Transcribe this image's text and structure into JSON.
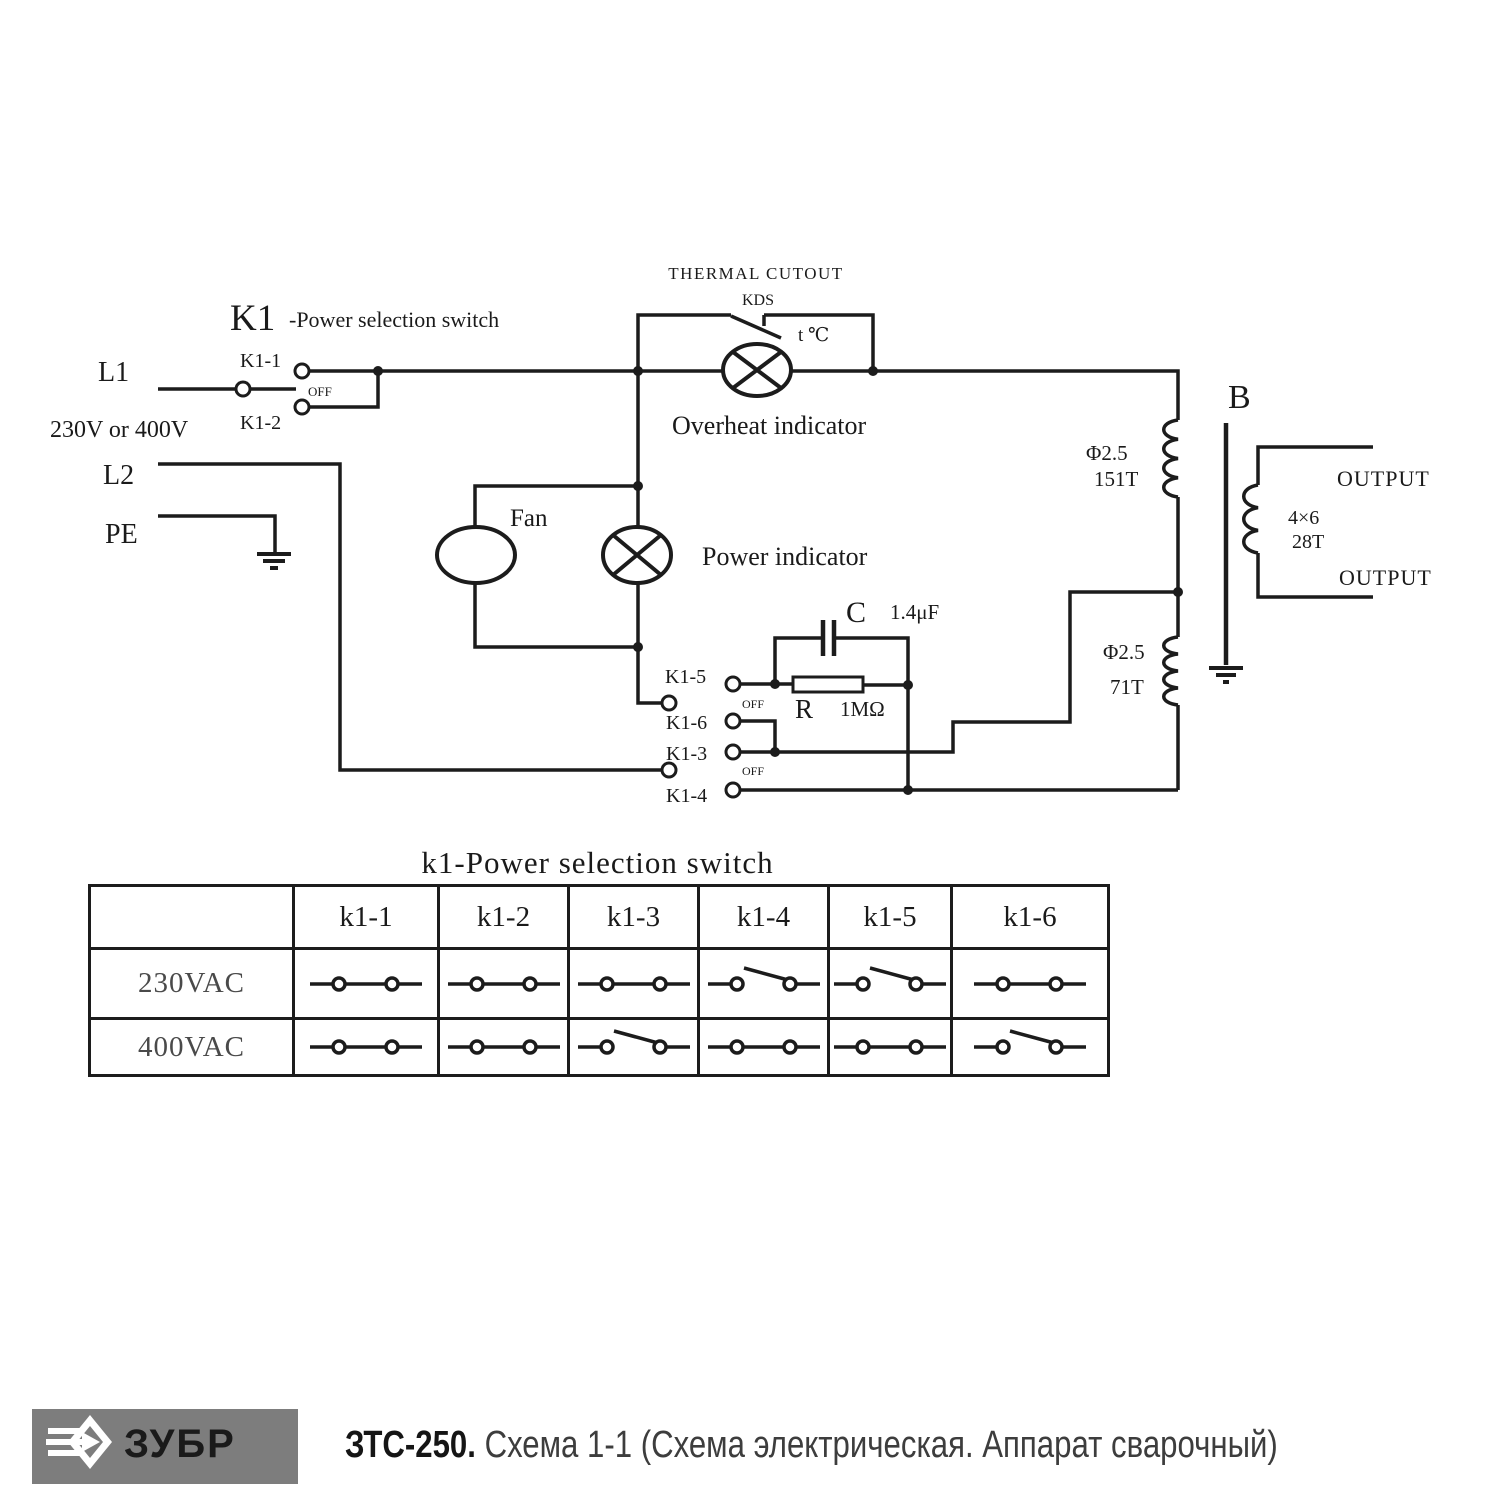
{
  "colors": {
    "line": "#1c1c1c",
    "logo_bg": "#7d7d7d",
    "footer_model": "#151515",
    "footer_desc": "#3d3d3d"
  },
  "diagram": {
    "labels": {
      "thermal_cutout": "THERMAL  CUTOUT",
      "kds": "KDS",
      "t_c": "t ℃",
      "k1_title": "K1",
      "k1_title_suffix": "-Power selection switch",
      "l1": "L1",
      "voltage": "230V or 400V",
      "l2": "L2",
      "pe": "PE",
      "k1_1": "K1-1",
      "k1_2": "K1-2",
      "k1_3": "K1-3",
      "k1_4": "K1-4",
      "k1_5": "K1-5",
      "k1_6": "K1-6",
      "off_k1": "OFF",
      "off_k5": "OFF",
      "off_k3": "OFF",
      "fan": "Fan",
      "overheat_indicator": "Overheat indicator",
      "power_indicator": "Power indicator",
      "cap_name": "C",
      "cap_value": "1.4μF",
      "res_name": "R",
      "res_value": "1MΩ",
      "primary_upper_wire": "Φ2.5",
      "primary_upper_turns": "151T",
      "primary_lower_wire": "Φ2.5",
      "primary_lower_turns": "71T",
      "transformer": "B",
      "secondary_wire": "4×6",
      "secondary_turns": "28T",
      "output_top": "OUTPUT",
      "output_bottom": "OUTPUT"
    }
  },
  "table": {
    "title": "k1-Power selection switch",
    "col_headers": [
      "k1-1",
      "k1-2",
      "k1-3",
      "k1-4",
      "k1-5",
      "k1-6"
    ],
    "rows": [
      {
        "label": "230VAC",
        "states": [
          "closed",
          "closed",
          "closed",
          "open",
          "open",
          "closed"
        ]
      },
      {
        "label": "400VAC",
        "states": [
          "closed",
          "closed",
          "open",
          "closed",
          "closed",
          "open"
        ]
      }
    ]
  },
  "footer": {
    "brand": "ЗУБР",
    "model": "ЗТС-250.",
    "description": "Схема 1-1 (Схема электрическая. Аппарат сварочный)"
  }
}
